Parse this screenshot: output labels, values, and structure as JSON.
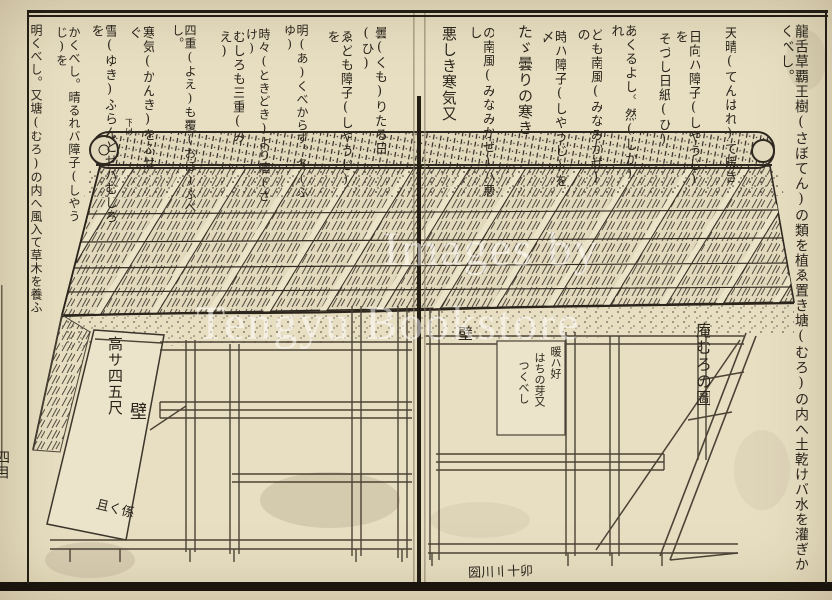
{
  "watermark": {
    "line1": "Images by",
    "line2": "Tengyu Bookstore"
  },
  "right_page": {
    "columns": [
      "龍舌草覇王樹(さぼてん)の類を植ゑ置き塘(むろ)の内へ土乾けバ水を灌ぎかくべし。",
      "天晴(てんはれ)て暖き",
      "日向ハ障子(しやうじ)を",
      "そづし日紙(ひ)",
      "あくるよし。然(しか)れ",
      "ども南風(みなみかぜ)の",
      "時ハ障子(しやうじ)を〆",
      "たゞ曇りの寒き",
      "の南風(みなみかぜ)ハ悪し",
      "悪しき寒気又"
    ],
    "labels": {
      "kabe": "壁",
      "caption": "庵むろの圖",
      "note_lines": [
        "暖ハ好",
        "はちの芽又",
        "つくべし"
      ],
      "corner_mark": "圀川〢十卯"
    }
  },
  "left_page": {
    "columns": [
      "曇(くも)りたる日(ひ)",
      "ゑども障子(しやうじ)を",
      "明(あ)くべからず。冬(ふゆ)",
      "時々(ときどき)より酒(さけ)",
      "むしろも三重(みえ)",
      "四重(よえ)も覆(おほ)ふべし。",
      "寒気(かんき)をふせぐ",
      "雪(ゆき)ふらんとせバむしろを",
      "かくべし。晴るれバ障子(しやうじ)を",
      "明くべし。又塘(むろ)の内へ風入て草木を養ふ"
    ],
    "labels": {
      "height": "高サ四五尺",
      "kabe": "壁",
      "rotated": "且く係",
      "ridge_note": "下け",
      "edge_chars": "四目"
    }
  },
  "colors": {
    "paper": "#e8dfc3",
    "ink": "#2b251c",
    "light_line": "#4c4336",
    "watermark": "#ffffff"
  }
}
